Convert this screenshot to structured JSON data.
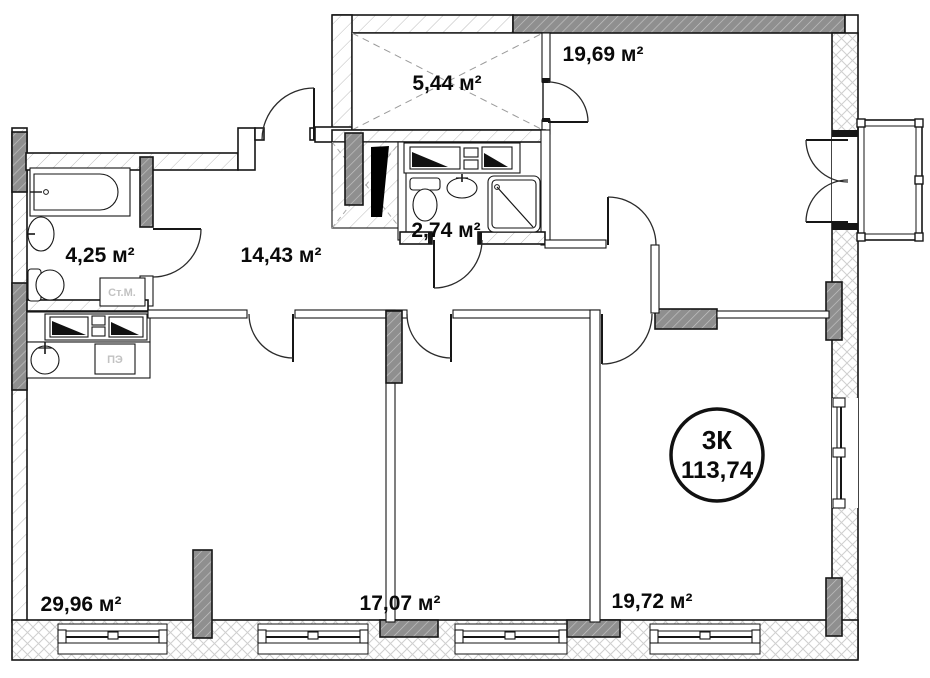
{
  "plan": {
    "badge": {
      "code": "3К",
      "area": "113,74"
    },
    "rooms": [
      {
        "id": "wardrobe",
        "label": "5,44 м²"
      },
      {
        "id": "room-top-right",
        "label": "19,69 м²"
      },
      {
        "id": "bathroom-small",
        "label": "2,74 м²"
      },
      {
        "id": "bathroom-left",
        "label": "4,25 м²"
      },
      {
        "id": "hallway",
        "label": "14,43 м²"
      },
      {
        "id": "kitchen-living",
        "label": "29,96 м²"
      },
      {
        "id": "room-mid-bottom",
        "label": "17,07 м²"
      },
      {
        "id": "room-bottom-right",
        "label": "19,72 м²"
      }
    ],
    "appliances": [
      {
        "id": "washing-machine",
        "label": "Ст.М."
      },
      {
        "id": "electric-stove",
        "label": "ПЭ"
      }
    ],
    "colors": {
      "line": "#161616",
      "wall_dark_fill": "#8f8f8f",
      "hatch_light": "#b9b9b9",
      "hatch_cross": "#cfcfcf",
      "room_label": "#0a0a0a",
      "appliance_label": "#c2c2c2"
    }
  }
}
